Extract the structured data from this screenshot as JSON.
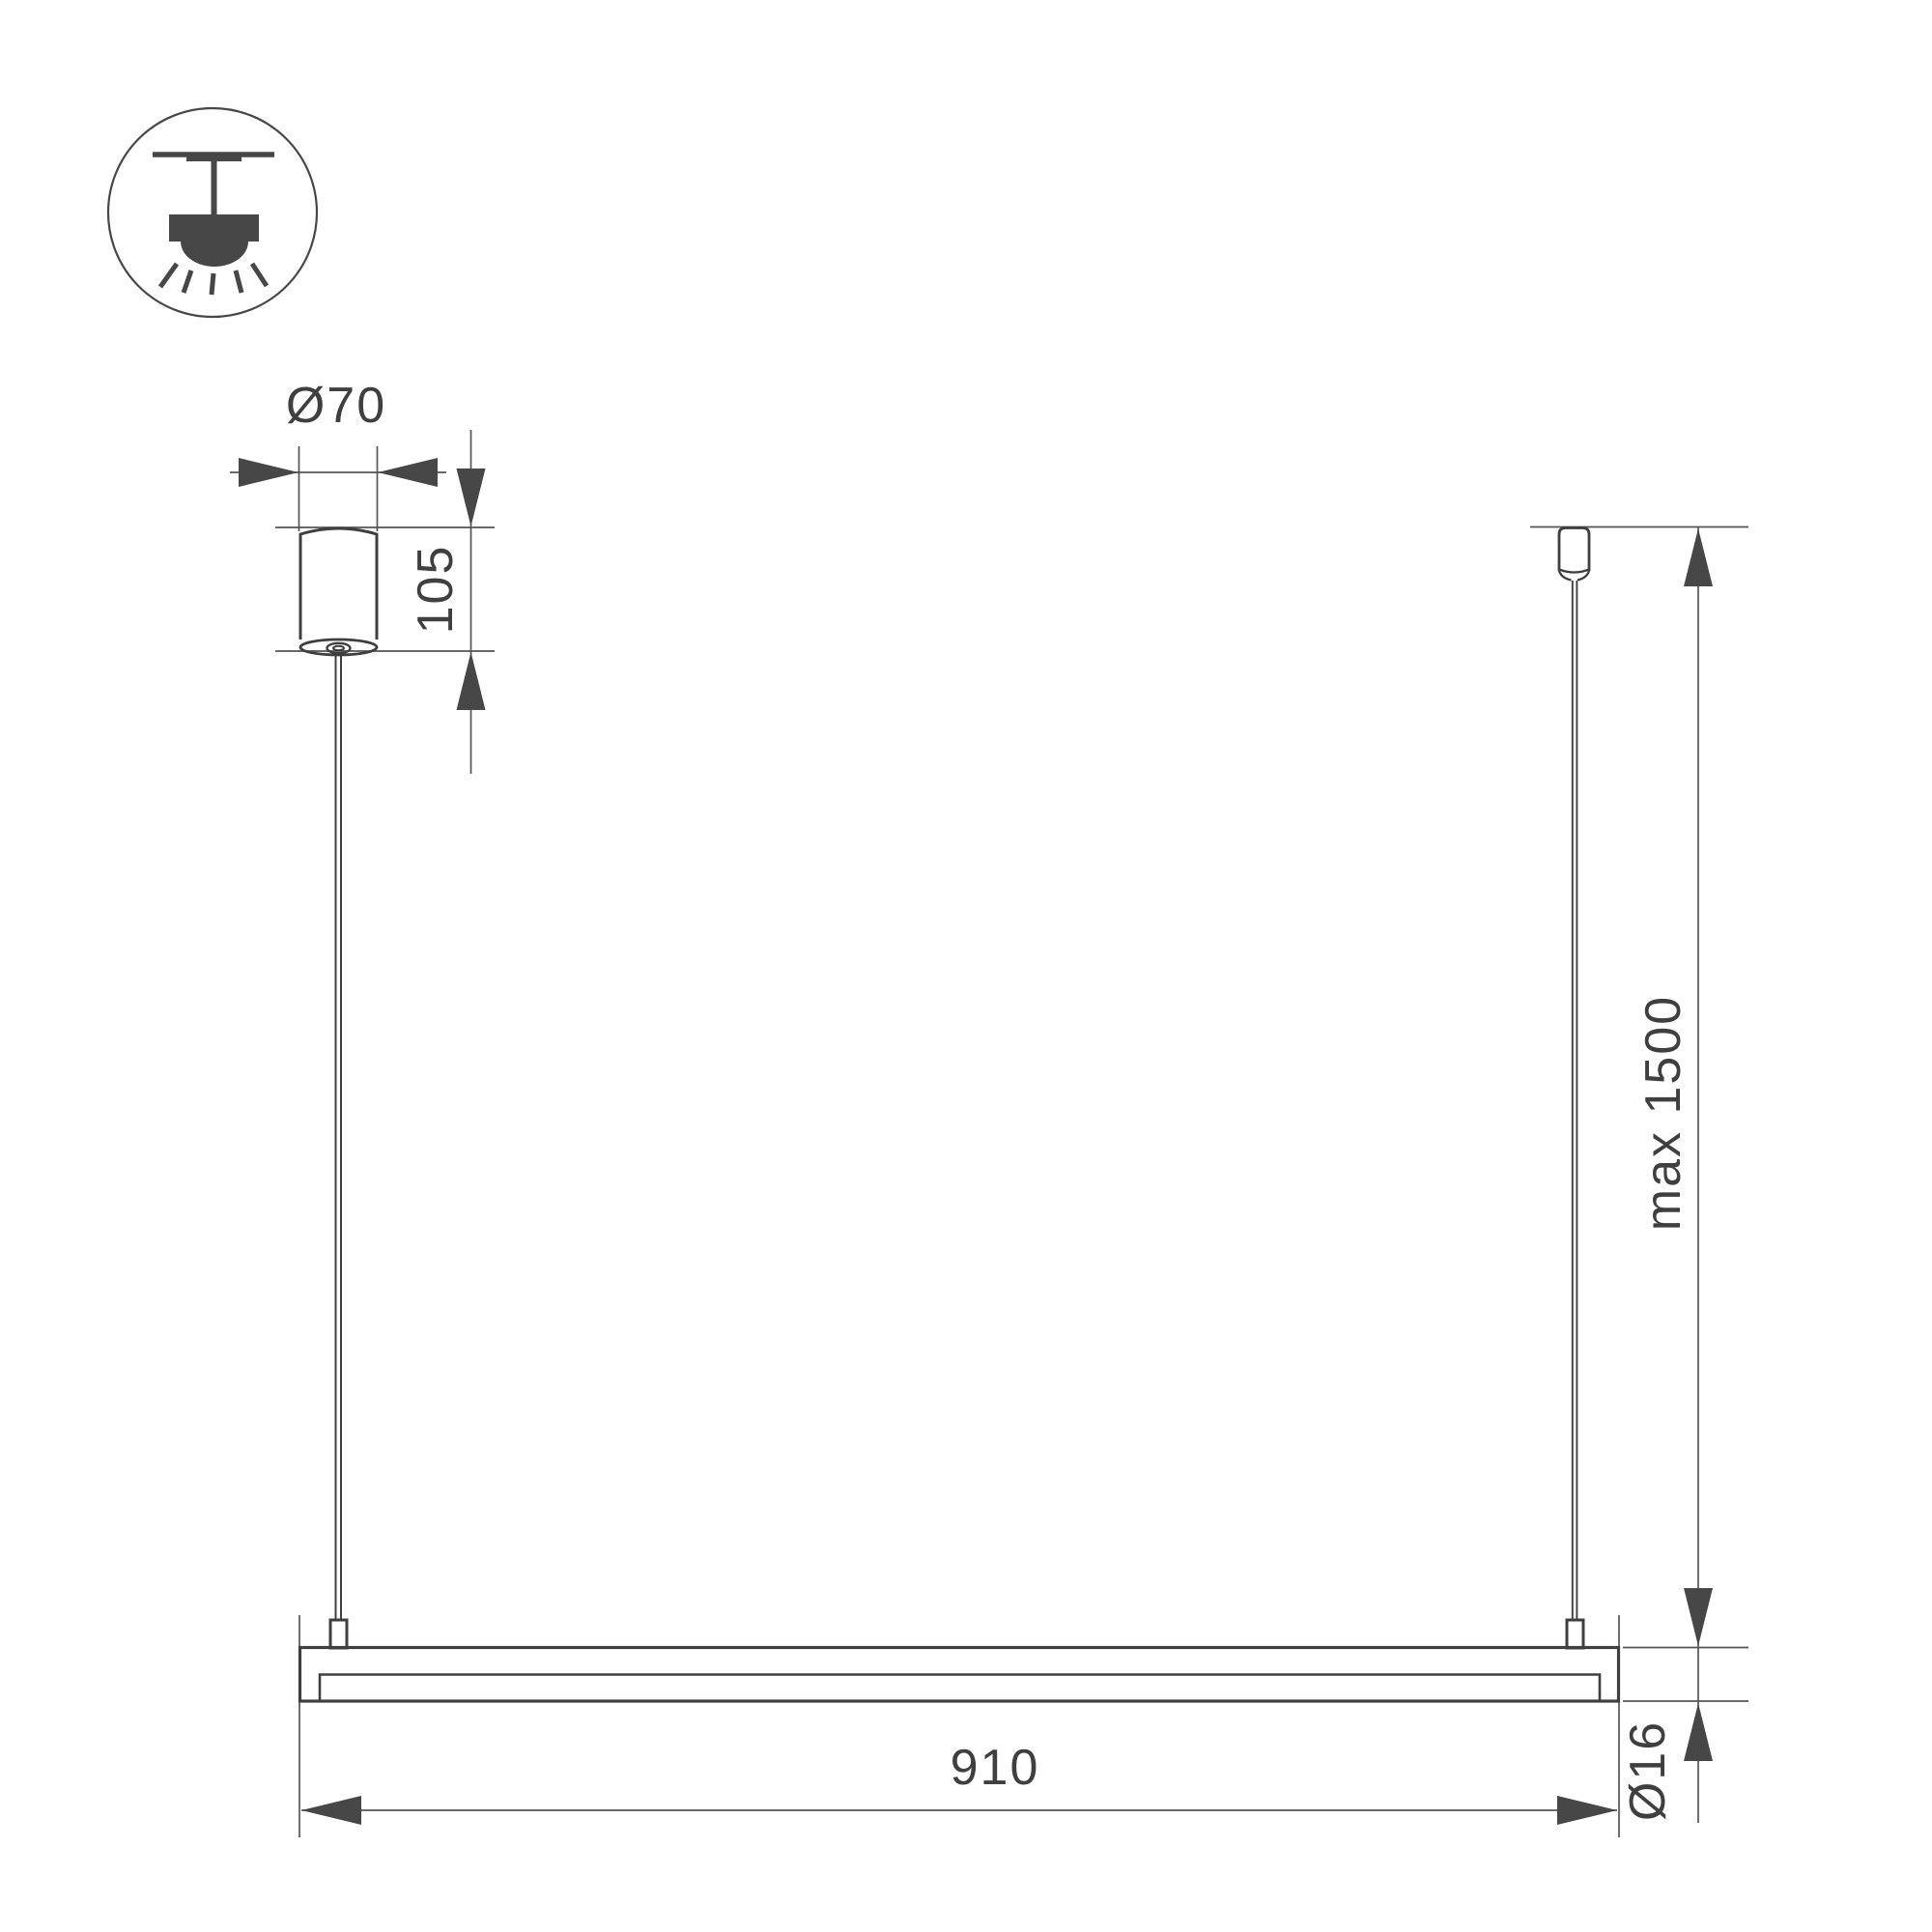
{
  "page": {
    "background": "#ffffff",
    "drawing_type": "Linear pendant luminaire dimensional drawing"
  },
  "colors": {
    "object_line": "#3f3f3f",
    "dimension_line": "#555555",
    "arrow_fill": "#474747",
    "text": "#3f3f3f"
  },
  "icon": {
    "name": "ceiling-pendant-mount-icon"
  },
  "dimensions": {
    "canopy_diameter": {
      "label": "Ø70"
    },
    "canopy_height": {
      "label": "105"
    },
    "suspension_length": {
      "label": "max 1500"
    },
    "bar_length": {
      "label": "910"
    },
    "bar_diameter": {
      "label": "Ø16"
    }
  }
}
